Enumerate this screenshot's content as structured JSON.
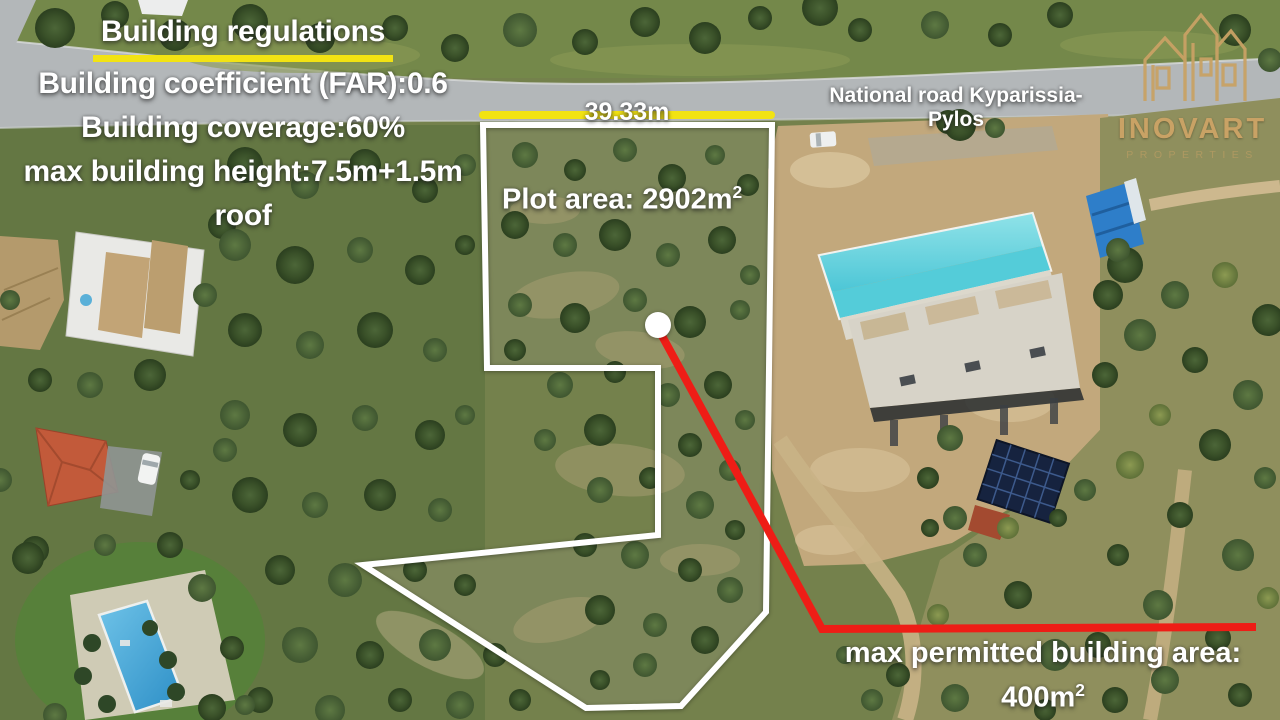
{
  "regulations": {
    "title": "Building regulations",
    "line1": "Building coefficient (FAR):0.6",
    "line2": "Building coverage:60%",
    "line3": "max building height:7.5m+1.5m",
    "line4": "roof"
  },
  "labels": {
    "road": "National road Kyparissia-Pylos",
    "frontage": "39.33m",
    "plot_area_text": "Plot area: 2902m",
    "plot_area_sup": "2",
    "max_area_line1": "max permitted building area:",
    "max_area_value": "400m",
    "max_area_sup": "2"
  },
  "logo": {
    "name": "INOVART",
    "subtitle": "PROPERTIES"
  },
  "palette": {
    "accent_yellow": "#f2e313",
    "accent_red": "#ee1d16",
    "boundary_white": "#ffffff",
    "logo_gold": "#c9a265",
    "pool_cyan": "#67d4e0",
    "road_gray": "#b3b7b9",
    "dirt_tan": "#c2a87c"
  }
}
